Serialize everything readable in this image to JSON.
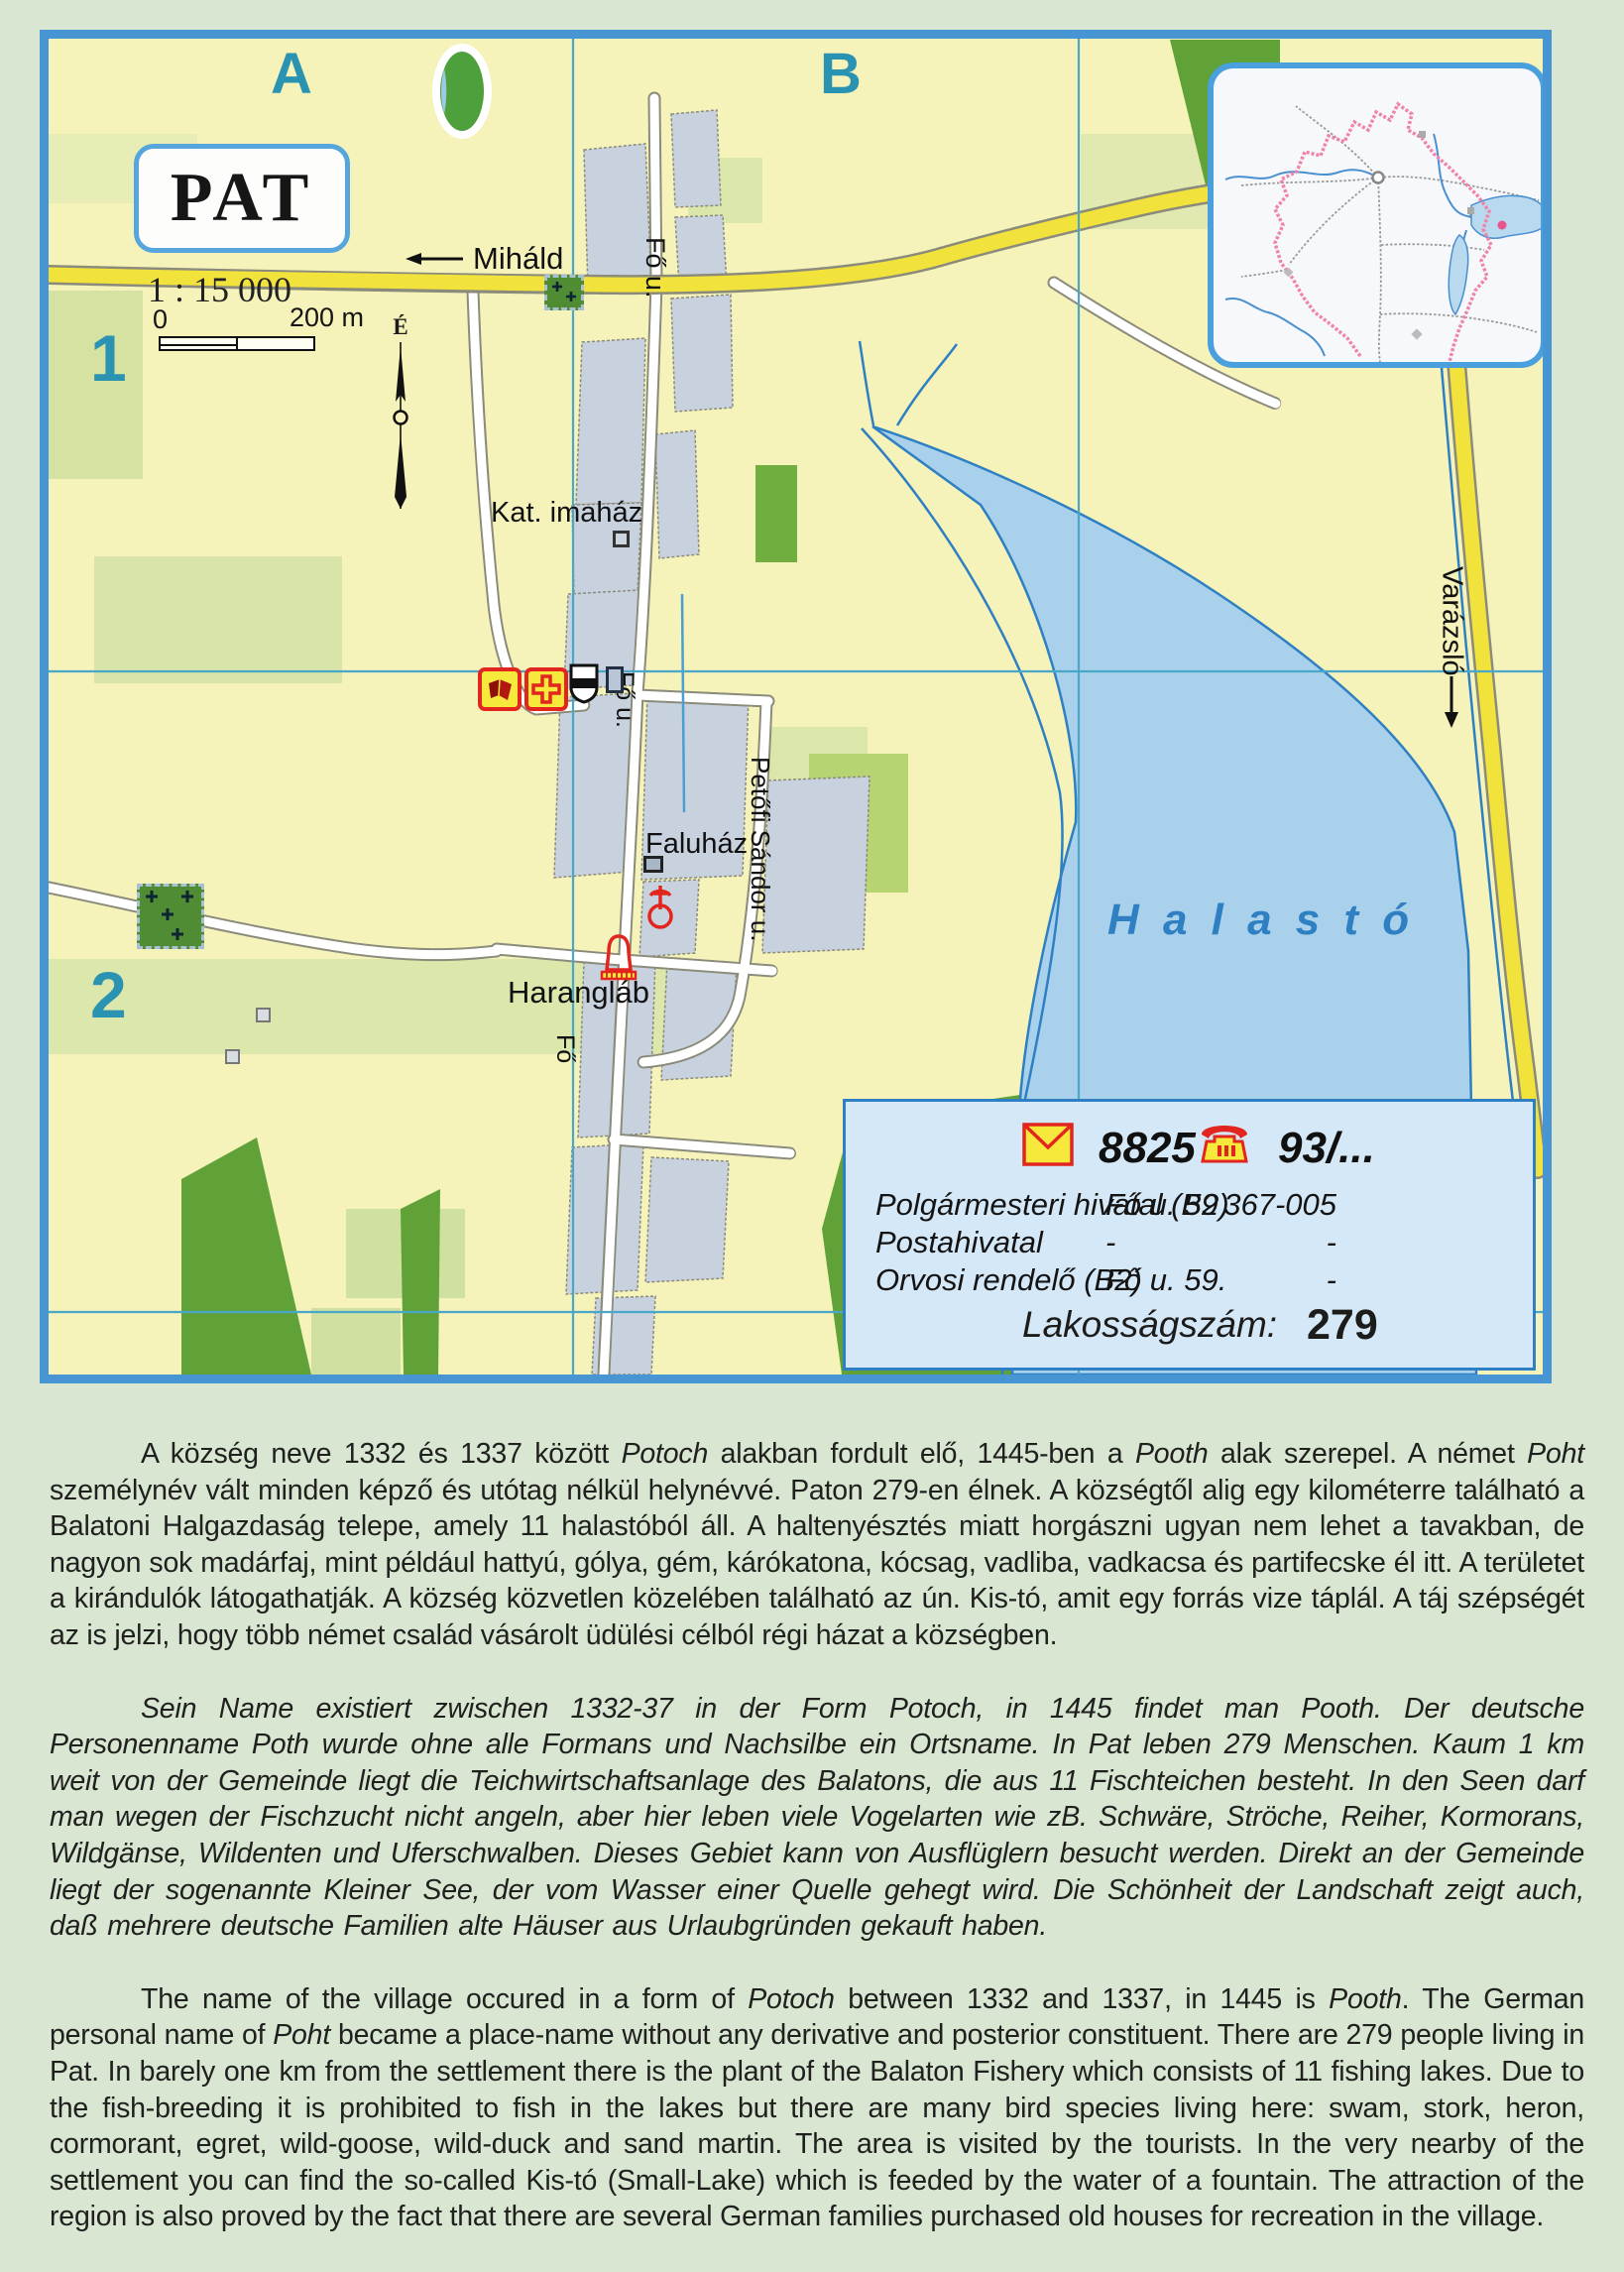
{
  "map": {
    "title": "PAT",
    "scale_text": "1 : 15 000",
    "scalebar": {
      "start": "0",
      "end": "200 m"
    },
    "north_label": "É",
    "grid": {
      "cols": [
        "A",
        "B"
      ],
      "rows": [
        "1",
        "2"
      ]
    },
    "labels": {
      "mihald": "Miháld",
      "fo_u_top": "Fő u.",
      "fo_u_mid": "Fő u.",
      "fo_bottom": "Fő",
      "petofi": "Petőfi Sándor u.",
      "kat_imahaz": "Kat. imaház",
      "faluhaz": "Faluház",
      "haranglab": "Harangláb",
      "halasto": "Halastó",
      "varazslo": "Varázsló"
    }
  },
  "infobox": {
    "postal_code": "8825",
    "phone_prefix": "93/...",
    "rows": [
      {
        "name": "Polgármesteri hivatal (B2)",
        "address": "Fő u. 59",
        "phone": "367-005"
      },
      {
        "name": "Postahivatal",
        "address": "-",
        "phone": "-"
      },
      {
        "name": "Orvosi rendelő (B2)",
        "address": "Fő u. 59.",
        "phone": "-"
      }
    ],
    "population_label": "Lakosságszám:",
    "population_value": "279"
  },
  "paragraphs": [
    {
      "lang": "hu",
      "segments": [
        {
          "text": "A község neve 1332 és 1337 között "
        },
        {
          "text": "Potoch",
          "italic": true
        },
        {
          "text": " alakban fordult elő, 1445-ben a "
        },
        {
          "text": "Pooth",
          "italic": true
        },
        {
          "text": " alak szerepel. A német "
        },
        {
          "text": "Poht",
          "italic": true
        },
        {
          "text": " személynév vált minden képző és utótag nélkül helynévvé. Paton 279-en élnek. A községtől alig egy kilométerre található a Balatoni Halgazdaság telepe, amely 11 halastóból áll. A haltenyésztés miatt horgászni ugyan nem lehet a tavakban, de nagyon sok madárfaj, mint például hattyú, gólya, gém, kárókatona, kócsag, vadliba, vadkacsa és partifecske él itt. A területet a kirándulók látogathatják. A község közvetlen közelében található az ún. Kis-tó, amit egy forrás vize táplál. A táj szépségét az is jelzi, hogy több német család vásárolt üdülési célból régi házat a községben."
        }
      ]
    },
    {
      "lang": "de",
      "segments": [
        {
          "text": "Sein Name existiert zwischen 1332-37 in der Form Potoch, in 1445 findet man Pooth. Der deutsche Personenname Poth wurde ohne alle Formans und Nachsilbe ein Ortsname. In Pat leben 279 Menschen. Kaum 1 km weit von der Gemeinde liegt die Teichwirtschaftsanlage des Balatons, die aus 11 Fischteichen besteht. In den Seen darf man wegen der Fischzucht nicht angeln, aber hier leben viele Vogelarten wie zB. Schwäre, Ströche, Reiher, Kormorans, Wildgänse, Wildenten und Uferschwalben. Dieses Gebiet kann von Ausflüglern besucht werden. Direkt an der Gemeinde liegt der sogenannte Kleiner See, der vom Wasser einer Quelle gehegt wird. Die Schönheit der Landschaft zeigt auch, daß mehrere deutsche Familien alte Häuser aus Urlaubgründen gekauft haben."
        }
      ]
    },
    {
      "lang": "en",
      "segments": [
        {
          "text": "The name of the village occured in a form of "
        },
        {
          "text": "Potoch",
          "italic": true
        },
        {
          "text": " between 1332 and 1337, in 1445 is "
        },
        {
          "text": "Pooth",
          "italic": true
        },
        {
          "text": ". The German personal name of "
        },
        {
          "text": "Poht",
          "italic": true
        },
        {
          "text": " became a place-name without any derivative and posterior constituent. There are 279 people living in Pat. In barely one km from the settlement there is the plant of the Balaton Fishery which consists of 11 fishing lakes. Due to the fish-breeding it is prohibited to fish in the lakes but there are many bird species living here: swam, stork, heron, cormorant, egret, wild-goose, wild-duck and sand martin. The area is visited by the tourists. In the very nearby of the settlement you can find the so-called Kis-tó (Small-Lake) which is feeded by the water of a fountain. The attraction of the region is also proved by the fact that there are several German families purchased old houses for recreation in the village."
        }
      ]
    }
  ],
  "colors": {
    "page_bg": "#d8e6d2",
    "map_bg": "#f5f2ba",
    "map_border": "#4795d2",
    "grid_line": "#49a8c8",
    "yellow_road": "#f2e23c",
    "lake_fill": "#a9d1ec",
    "lake_line": "#2f80c3",
    "builtup": "#c8d2df",
    "forest": "#60a238",
    "field": "#d9e4a4",
    "icon_red": "#e2251f",
    "icon_yellow": "#f6e93c",
    "infobox_bg": "#d5e8f7",
    "inset_boundary_pink": "#ef84a8"
  }
}
